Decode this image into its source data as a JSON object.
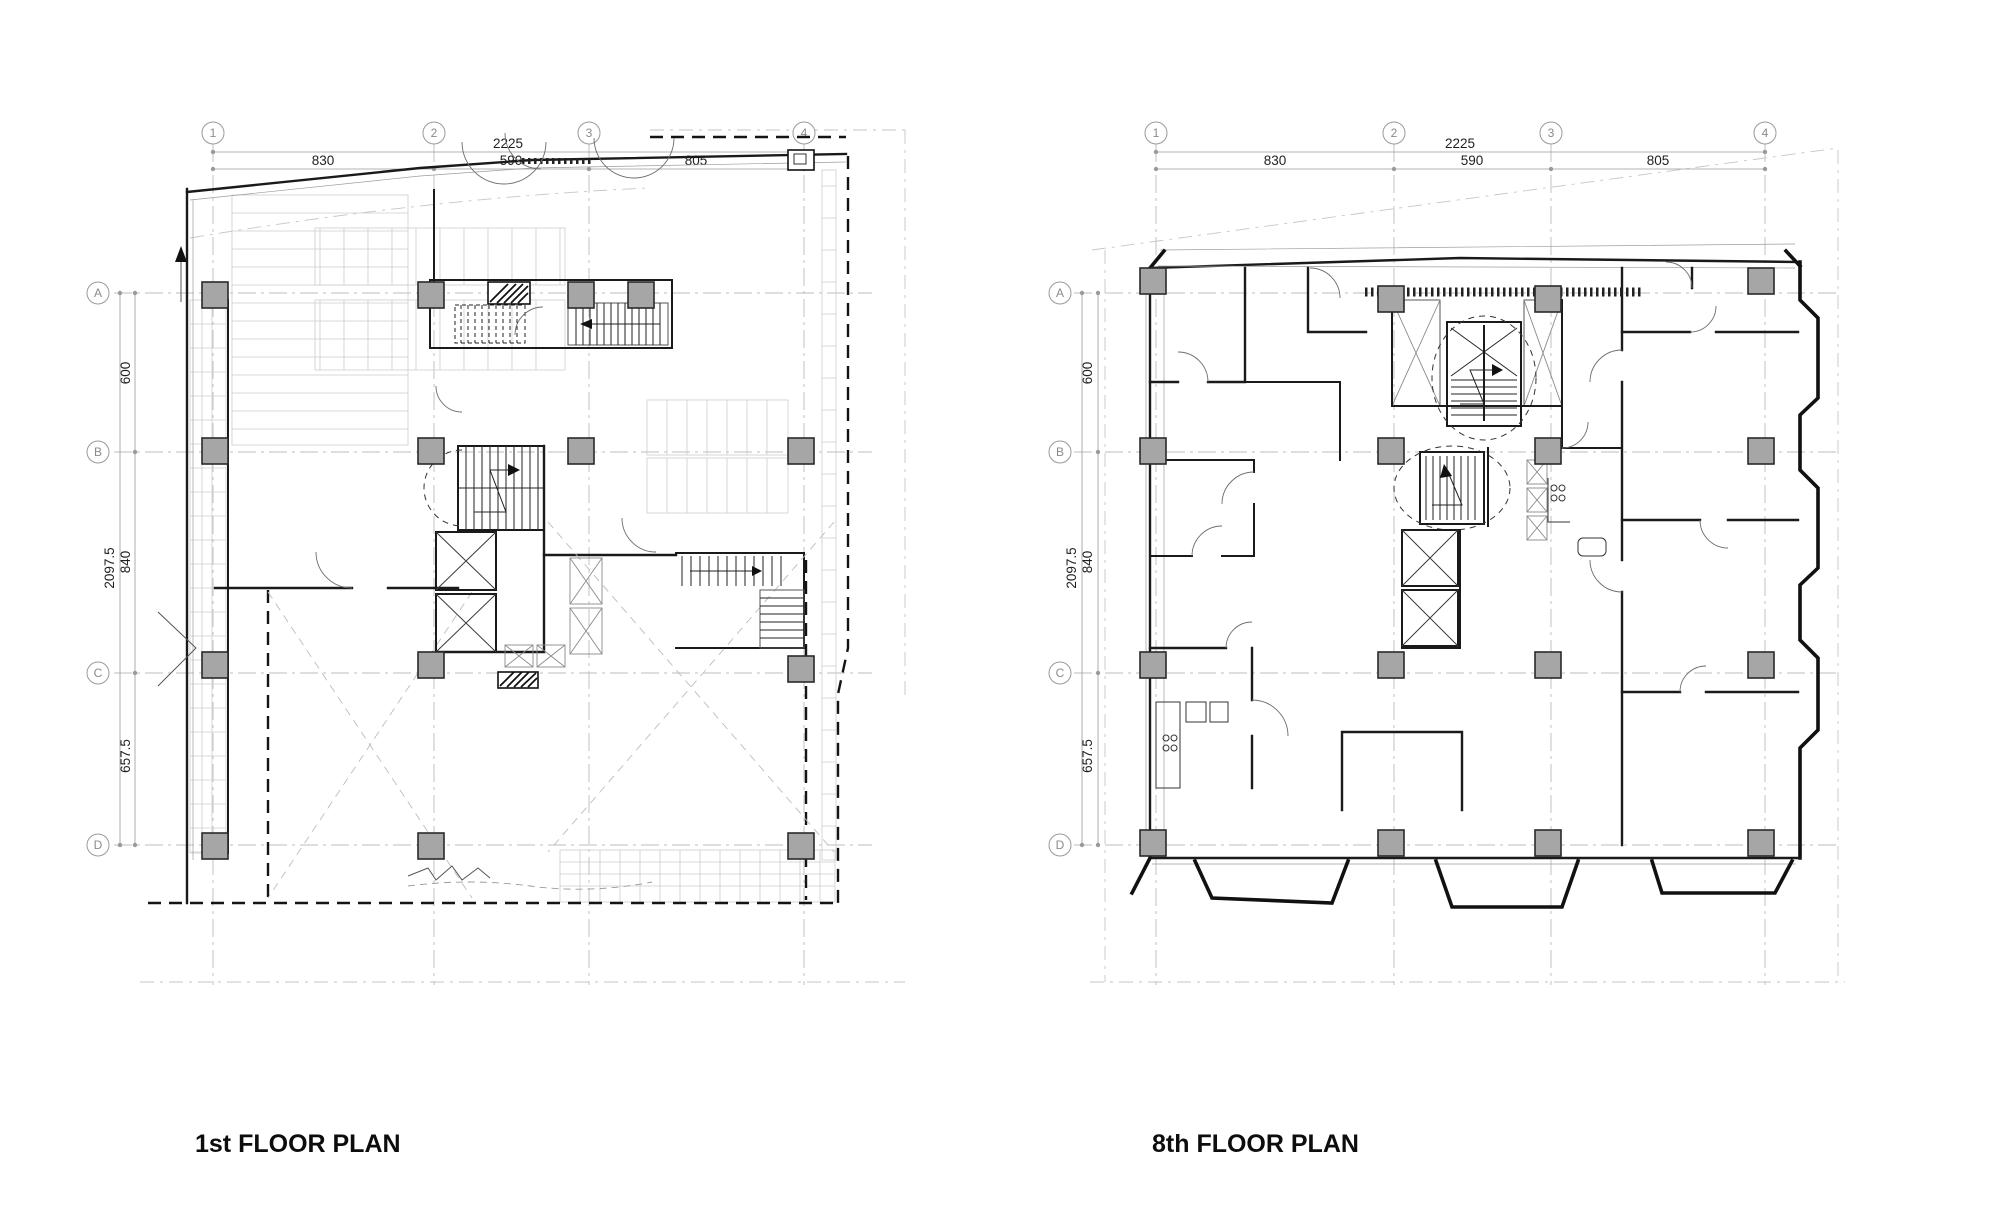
{
  "colors": {
    "paper": "#ffffff",
    "wall_black": "#1a1a1a",
    "grid_gray": "#bcbcbc",
    "dimension_gray": "#9a9a9a",
    "dimension_text": "#1f1f1f",
    "bubble_text": "#8a8a8a",
    "column_fill": "#a6a6a6",
    "stall_gray": "#cdcdcd"
  },
  "plans": [
    {
      "title": "1st FLOOR PLAN",
      "grid": {
        "columns": [
          "1",
          "2",
          "3",
          "4"
        ],
        "rows": [
          "A",
          "B",
          "C",
          "D"
        ]
      },
      "dimensions": {
        "top": {
          "overall": "2225",
          "segments": [
            "830",
            "590",
            "805"
          ]
        },
        "left": {
          "overall": "2097.5",
          "segments": [
            "600",
            "840",
            "657.5"
          ]
        }
      }
    },
    {
      "title": "8th FLOOR PLAN",
      "grid": {
        "columns": [
          "1",
          "2",
          "3",
          "4"
        ],
        "rows": [
          "A",
          "B",
          "C",
          "D"
        ]
      },
      "dimensions": {
        "top": {
          "overall": "2225",
          "segments": [
            "830",
            "590",
            "805"
          ]
        },
        "left": {
          "overall": "2097.5",
          "segments": [
            "600",
            "840",
            "657.5"
          ]
        }
      }
    }
  ]
}
